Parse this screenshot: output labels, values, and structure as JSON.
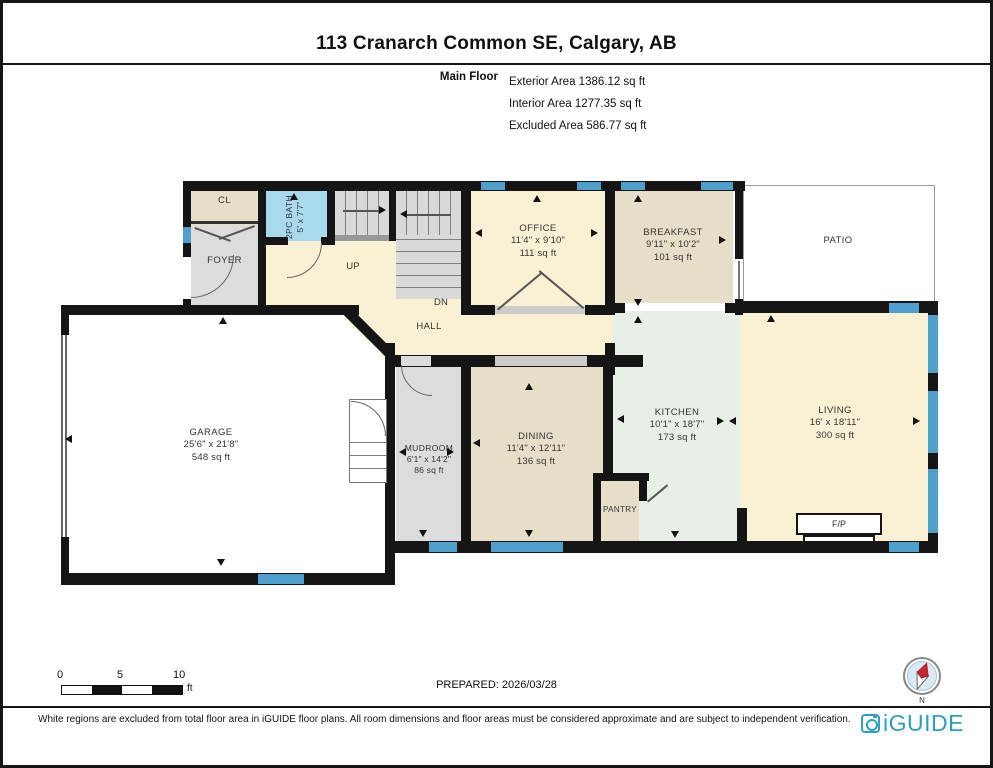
{
  "header": {
    "title": "113 Cranarch Common SE, Calgary, AB",
    "floor_label": "Main Floor",
    "stats": [
      "Exterior Area 1386.12 sq ft",
      "Interior Area 1277.35 sq ft",
      "Excluded Area 586.77 sq ft"
    ]
  },
  "rooms": {
    "cl": {
      "name": "CL"
    },
    "foyer": {
      "name": "FOYER"
    },
    "bath": {
      "name": "2PC BATH",
      "dims": "5' x 7'7\""
    },
    "up": {
      "name": "UP"
    },
    "dn": {
      "name": "DN"
    },
    "hall": {
      "name": "HALL"
    },
    "office": {
      "name": "OFFICE",
      "dims": "11'4\" x 9'10\"",
      "area": "111 sq ft"
    },
    "breakfast": {
      "name": "BREAKFAST",
      "dims": "9'11\" x 10'2\"",
      "area": "101 sq ft"
    },
    "patio": {
      "name": "PATIO"
    },
    "garage": {
      "name": "GARAGE",
      "dims": "25'6\" x 21'8\"",
      "area": "548 sq ft"
    },
    "mudroom": {
      "name": "MUDROOM",
      "dims": "6'1\" x 14'2\"",
      "area": "86 sq ft"
    },
    "dining": {
      "name": "DINING",
      "dims": "11'4\" x 12'11\"",
      "area": "136 sq ft"
    },
    "kitchen": {
      "name": "KITCHEN",
      "dims": "10'1\" x 18'7\"",
      "area": "173 sq ft"
    },
    "pantry": {
      "name": "PANTRY"
    },
    "living": {
      "name": "LIVING",
      "dims": "16' x 18'11\"",
      "area": "300 sq ft"
    },
    "fireplace": {
      "name": "F/P"
    }
  },
  "scale_bar": {
    "ticks": [
      "0",
      "5",
      "10"
    ],
    "unit": "ft"
  },
  "footer": {
    "prepared": "PREPARED: 2026/03/28",
    "disclaimer": "White regions are excluded from total floor area in iGUIDE floor plans. All room dimensions and floor areas must be considered approximate and are subject to independent verification."
  },
  "branding": {
    "logo_text": "iGUIDE",
    "compass_north": "N"
  },
  "colors": {
    "wall": "#151515",
    "window_blue": "#4E9FCC",
    "bath_blue": "#A9D9EF",
    "kitchen_green": "#E7EFE7",
    "room_tan": "#E7DEC9",
    "room_cream": "#FAF1D4",
    "room_gray": "#DCDCDC",
    "brand_teal": "#2E9FBF"
  }
}
